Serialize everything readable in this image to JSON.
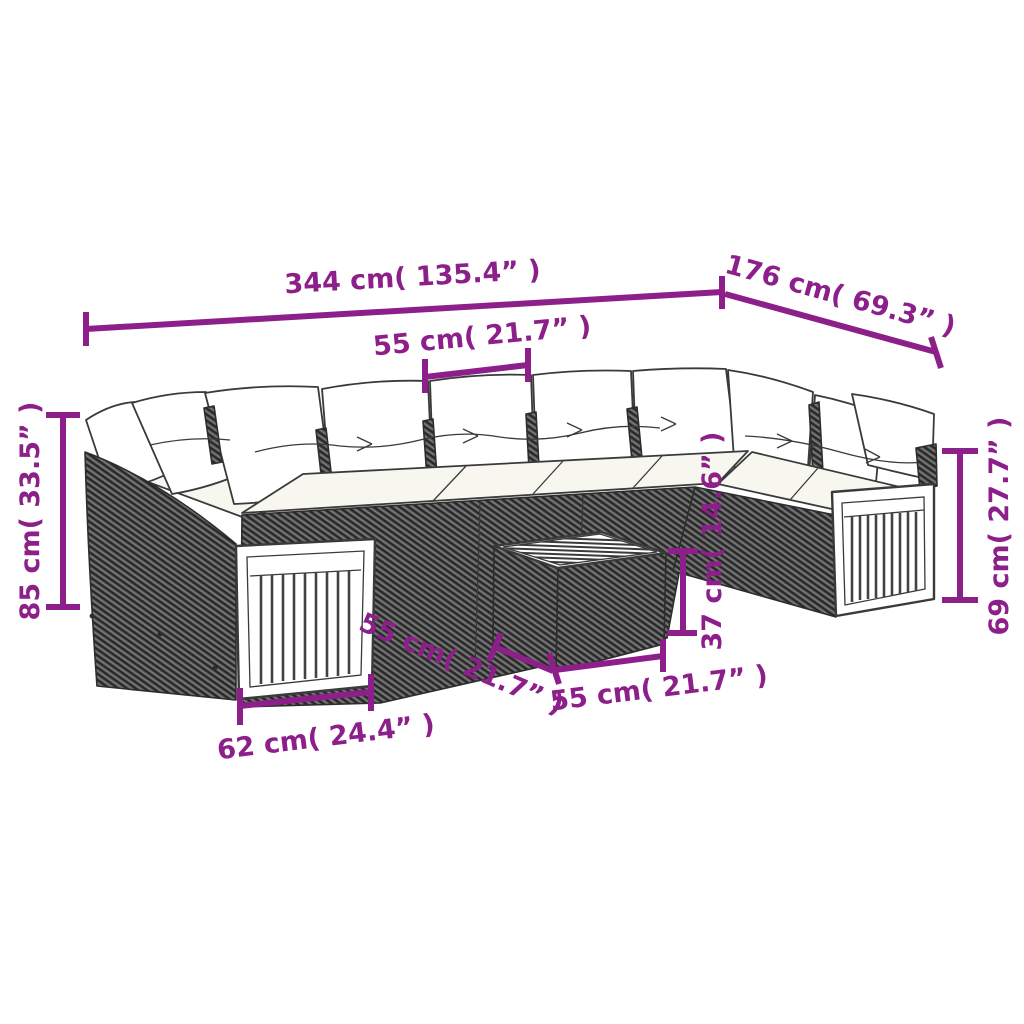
{
  "diagram": {
    "type": "product-dimension-diagram",
    "subject": "poly-rattan-garden-lounge-set-with-coffee-table",
    "accent_color": "#8C1F8A",
    "drawing_line_color": "#3A3A3A",
    "dimensions": {
      "total_width": "344 cm( 135.4” )",
      "total_depth": "176 cm( 69.3” )",
      "seat_module_width": "55 cm( 21.7” )",
      "back_height": "85 cm( 33.5” )",
      "arm_height": "69 cm( 27.7” )",
      "table_height": "37 cm( 14.6” )",
      "arm_section_width": "62 cm( 24.4” )",
      "table_depth": "55 cm( 21.7” )",
      "table_width": "55 cm( 21.7” )"
    }
  }
}
